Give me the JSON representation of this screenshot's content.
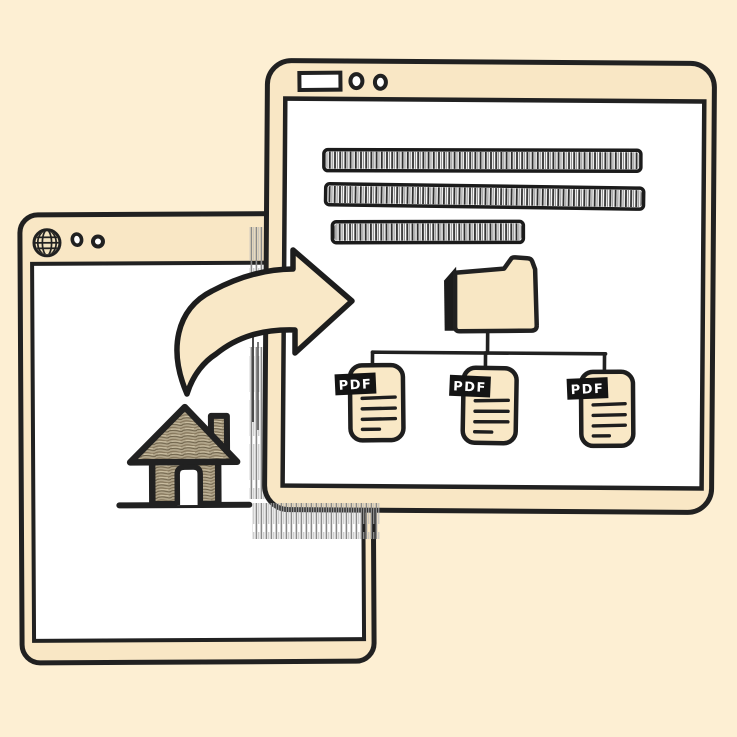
{
  "illustration": {
    "description": "hand-drawn sketch of a webpage being converted into a folder of PDF files",
    "colors": {
      "background": "#FDEFD3",
      "window_fill": "#F9E7C5",
      "content_fill": "#FFFFFF",
      "outline": "#212121",
      "arrow_fill": "#F9E8C7",
      "folder_fill": "#F8E7C4",
      "pdf_doc_fill": "#F9E8C6",
      "pdf_label_bg": "#141414",
      "pdf_label_text": "#FFFFFF",
      "house_fill": "#B3A78C",
      "shadow_hatch": "#8A8A8A"
    },
    "back_window": {
      "titlebar_icons": [
        {
          "icon": "globe-icon"
        },
        {
          "icon": "window-control-circle"
        },
        {
          "icon": "window-control-circle"
        }
      ],
      "content_icon": "house-icon"
    },
    "front_window": {
      "titlebar": {
        "address_bar": "",
        "controls": [
          {
            "icon": "window-control-circle"
          },
          {
            "icon": "window-control-circle"
          }
        ]
      },
      "text_placeholder_bars": 3,
      "folder_icon": "folder-icon",
      "pdf_files": [
        {
          "label": "PDF"
        },
        {
          "label": "PDF"
        },
        {
          "label": "PDF"
        }
      ]
    },
    "arrow": {
      "icon": "curved-arrow-icon",
      "direction": "left-window-to-right-window"
    }
  }
}
